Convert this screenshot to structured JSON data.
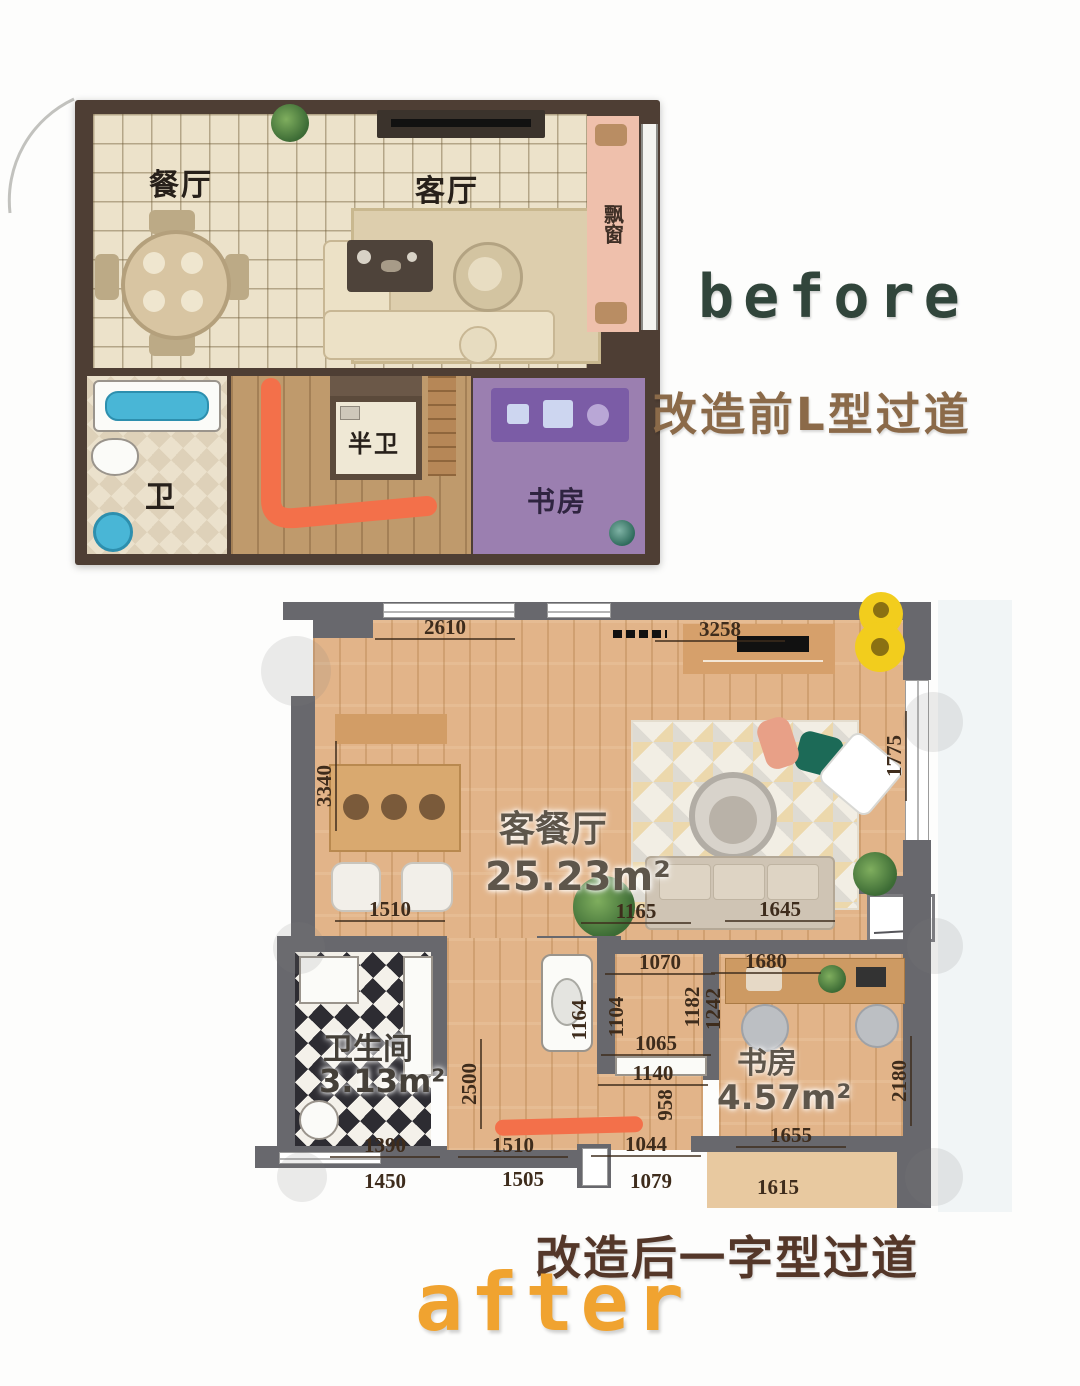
{
  "before_section": {
    "label": "before",
    "caption": "改造前L型过道",
    "plan": {
      "rooms": {
        "dining": "餐厅",
        "living": "客厅",
        "bay_window": "飘窗",
        "half_bath": "半卫",
        "bath": "卫",
        "study": "书房"
      }
    }
  },
  "after_section": {
    "label": "after",
    "caption": "改造后一字型过道",
    "plan": {
      "rooms": {
        "living_dining": {
          "name": "客餐厅",
          "area": "25.23m²"
        },
        "bathroom": {
          "name": "卫生间",
          "area": "3.13m²"
        },
        "study": {
          "name": "书房",
          "area": "4.57m²"
        }
      },
      "dimensions": {
        "d2610": "2610",
        "d3258": "3258",
        "d3340": "3340",
        "d1775": "1775",
        "d1510_a": "1510",
        "d1165": "1165",
        "d1645": "1645",
        "d1070": "1070",
        "d1680": "1680",
        "d1164": "1164",
        "d1104": "1104",
        "d1182": "1182",
        "d1242": "1242",
        "d2500": "2500",
        "d1065": "1065",
        "d1140": "1140",
        "d958": "958",
        "d2180": "2180",
        "d1390": "1390",
        "d1510_b": "1510",
        "d1044": "1044",
        "d1655": "1655",
        "d1450": "1450",
        "d1505": "1505",
        "d1079": "1079",
        "d1615": "1615"
      }
    }
  },
  "colors": {
    "marker_orange": "#F3704A",
    "before_label_green": "#31453B",
    "before_caption_brown": "#8B6A49",
    "after_caption_brown": "#543729",
    "after_label_orange": "#F0A330",
    "pin_yellow": "#F2CD1D"
  }
}
